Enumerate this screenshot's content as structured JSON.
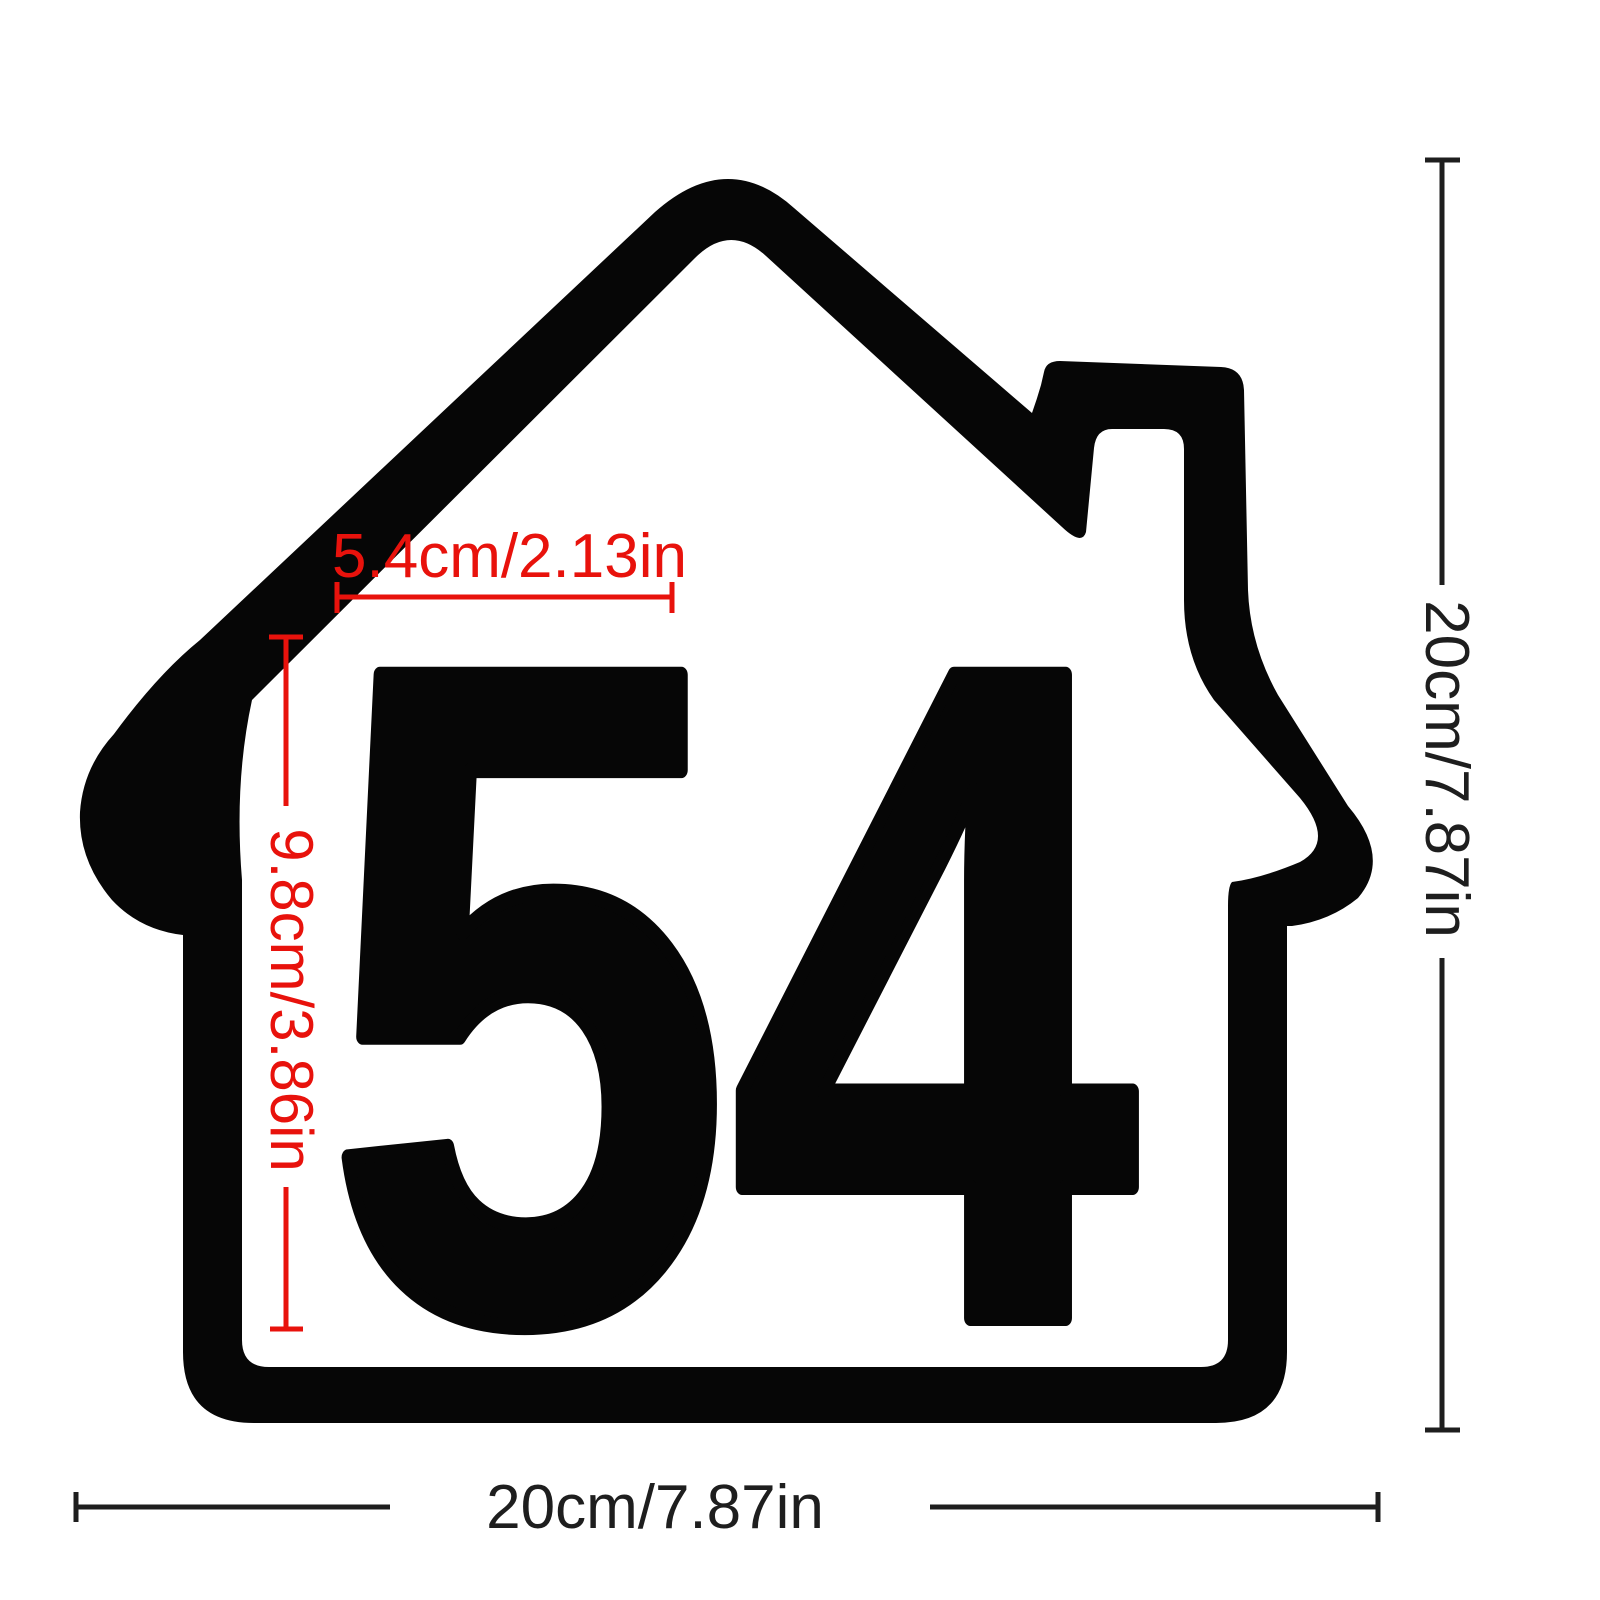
{
  "product_diagram": {
    "title_semantic": "house-number-sticker-dimension-diagram",
    "house_number": "54",
    "colors": {
      "shape": "#060606",
      "annotation_red": "#e8120c",
      "annotation_black": "#1e1e1e",
      "background": "#ffffff"
    },
    "annotations": {
      "digit_width": {
        "label": "5.4cm/2.13in",
        "unit_cm": 5.4,
        "unit_in": 2.13
      },
      "digit_height": {
        "label": "9.8cm/3.86in",
        "unit_cm": 9.8,
        "unit_in": 3.86
      },
      "overall_height": {
        "label": "20cm/7.87in",
        "unit_cm": 20,
        "unit_in": 7.87
      },
      "overall_width": {
        "label": "20cm/7.87in",
        "unit_cm": 20,
        "unit_in": 7.87
      }
    }
  }
}
